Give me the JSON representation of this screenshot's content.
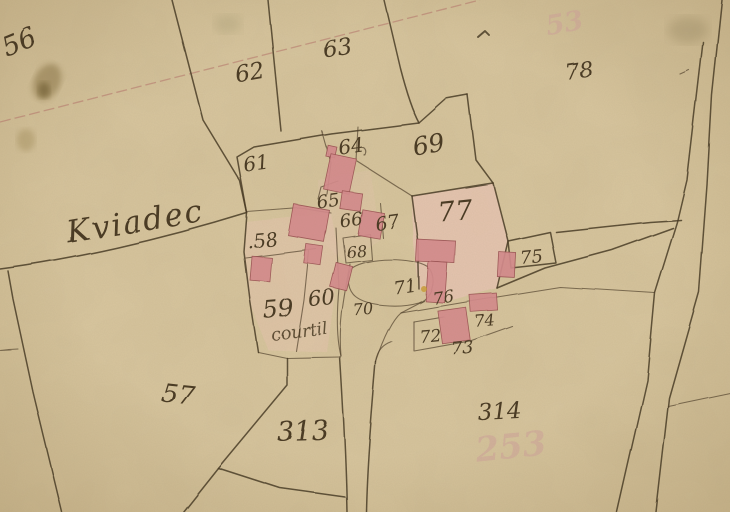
{
  "map": {
    "place_name": "Kviadec",
    "land_note": "courtil",
    "parcel_numbers_visible": [
      "56",
      "57",
      "58",
      "59",
      "60",
      "61",
      "62",
      "63",
      "64",
      "65",
      "66",
      "67",
      "68",
      "69",
      "70",
      "71",
      "72",
      "73",
      "74",
      "75",
      "76",
      "77",
      "78",
      "313",
      "314"
    ],
    "ghost_numbers_visible": [
      "53",
      "253"
    ],
    "colors": {
      "paper": "#d9c7a0",
      "ink": "#473823",
      "redline": "#b26a66",
      "building": "#d58a8e",
      "building_stroke": "#9a5052",
      "wash": "#e9c4b6",
      "ghost": "#cfa39b"
    },
    "labels": [
      {
        "kind": "parcel",
        "text": "56",
        "x": 22,
        "y": 50,
        "size": 27,
        "rot": -22
      },
      {
        "kind": "parcel",
        "text": "62",
        "x": 251,
        "y": 80,
        "size": 23,
        "rot": -10
      },
      {
        "kind": "parcel",
        "text": "63",
        "x": 338,
        "y": 55,
        "size": 23,
        "rot": -8
      },
      {
        "kind": "parcel",
        "text": "78",
        "x": 580,
        "y": 78,
        "size": 22,
        "rot": -8
      },
      {
        "kind": "parcel",
        "text": "61",
        "x": 257,
        "y": 170,
        "size": 20,
        "rot": -8
      },
      {
        "kind": "parcel",
        "text": "64",
        "x": 352,
        "y": 153,
        "size": 20,
        "rot": -8
      },
      {
        "kind": "parcel",
        "text": "69",
        "x": 430,
        "y": 153,
        "size": 25,
        "rot": -10
      },
      {
        "kind": "parcel",
        "text": "65",
        "x": 329,
        "y": 207,
        "size": 18,
        "rot": -8
      },
      {
        "kind": "parcel",
        "text": "66",
        "x": 352,
        "y": 226,
        "size": 18,
        "rot": -8
      },
      {
        "kind": "parcel",
        "text": "67",
        "x": 388,
        "y": 229,
        "size": 19,
        "rot": -8
      },
      {
        "kind": "parcel",
        "text": "68",
        "x": 357,
        "y": 257,
        "size": 16,
        "rot": -5
      },
      {
        "kind": "parcel",
        "text": ".58",
        "x": 263,
        "y": 247,
        "size": 19,
        "rot": -5
      },
      {
        "kind": "parcel",
        "text": "59",
        "x": 279,
        "y": 317,
        "size": 24,
        "rot": -5
      },
      {
        "kind": "parcel",
        "text": "60",
        "x": 322,
        "y": 305,
        "size": 21,
        "rot": -5
      },
      {
        "kind": "parcel",
        "text": "70",
        "x": 364,
        "y": 315,
        "size": 16,
        "rot": -5
      },
      {
        "kind": "parcel",
        "text": "71",
        "x": 406,
        "y": 293,
        "size": 18,
        "rot": -8
      },
      {
        "kind": "parcel",
        "text": "76",
        "x": 444,
        "y": 303,
        "size": 17,
        "rot": -8
      },
      {
        "kind": "parcel",
        "text": "75",
        "x": 532,
        "y": 263,
        "size": 18,
        "rot": -5
      },
      {
        "kind": "parcel",
        "text": "72",
        "x": 431,
        "y": 342,
        "size": 17,
        "rot": -5
      },
      {
        "kind": "parcel",
        "text": "73",
        "x": 463,
        "y": 354,
        "size": 18,
        "rot": -5
      },
      {
        "kind": "parcel",
        "text": "74",
        "x": 485,
        "y": 326,
        "size": 16,
        "rot": -5
      },
      {
        "kind": "parcel",
        "text": "77",
        "x": 456,
        "y": 220,
        "size": 27,
        "rot": -6
      },
      {
        "kind": "parcel",
        "text": "57",
        "x": 177,
        "y": 403,
        "size": 26,
        "rot": 6
      },
      {
        "kind": "parcel",
        "text": "313",
        "x": 303,
        "y": 440,
        "size": 27,
        "rot": -2
      },
      {
        "kind": "parcel",
        "text": "314",
        "x": 500,
        "y": 419,
        "size": 23,
        "rot": -3
      },
      {
        "kind": "place",
        "text": "Kviadec",
        "x": 137,
        "y": 232,
        "size": 31,
        "rot": -9
      },
      {
        "kind": "note",
        "text": "courtil",
        "x": 300,
        "y": 337,
        "size": 17,
        "rot": -7
      },
      {
        "kind": "ghost",
        "text": "53",
        "x": 566,
        "y": 32,
        "size": 27,
        "rot": -10
      },
      {
        "kind": "ghost",
        "text": "253",
        "x": 512,
        "y": 458,
        "size": 34,
        "rot": -6
      }
    ]
  }
}
